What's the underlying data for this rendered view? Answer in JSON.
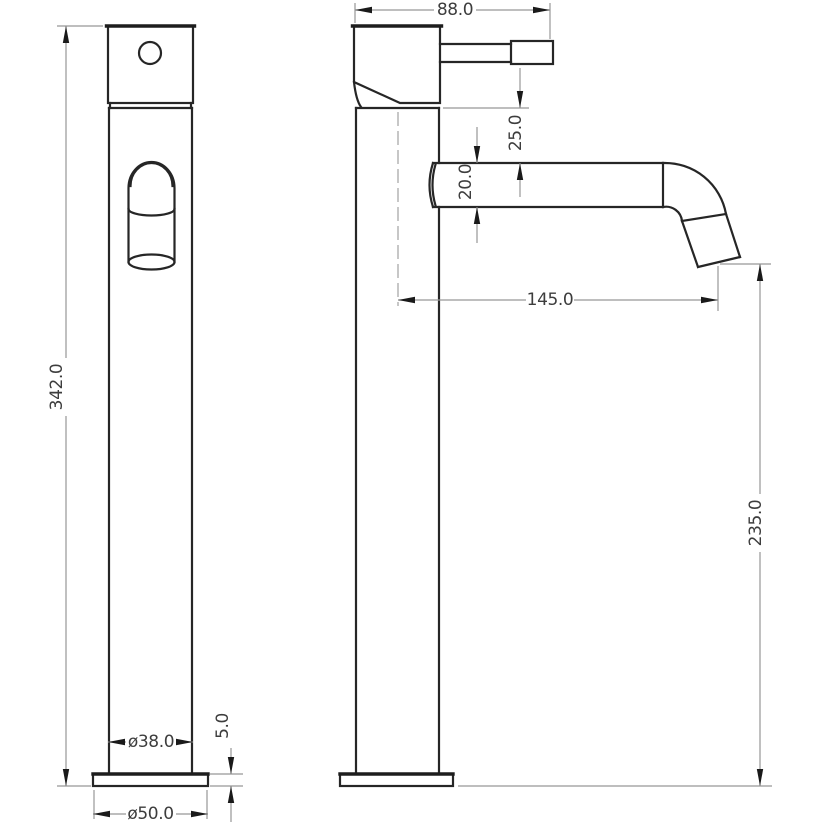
{
  "drawing": {
    "kind": "2-view technical drawing",
    "subject": "tall single-lever vessel basin mixer tap, front and side elevations",
    "units": "mm",
    "colors": {
      "object_line": "#262626",
      "dimension_line": "#979797",
      "text": "#3d3d3d",
      "background": "#ffffff"
    }
  },
  "dims": {
    "head_width_with_handle": "88.0",
    "head_to_spout_top": "25.0",
    "spout_tube_diameter": "20.0",
    "spout_reach": "145.0",
    "overall_height": "342.0",
    "outlet_to_base": "235.0",
    "body_diameter": "ø38.0",
    "base_plate_thickness": "5.0",
    "base_diameter": "ø50.0"
  }
}
